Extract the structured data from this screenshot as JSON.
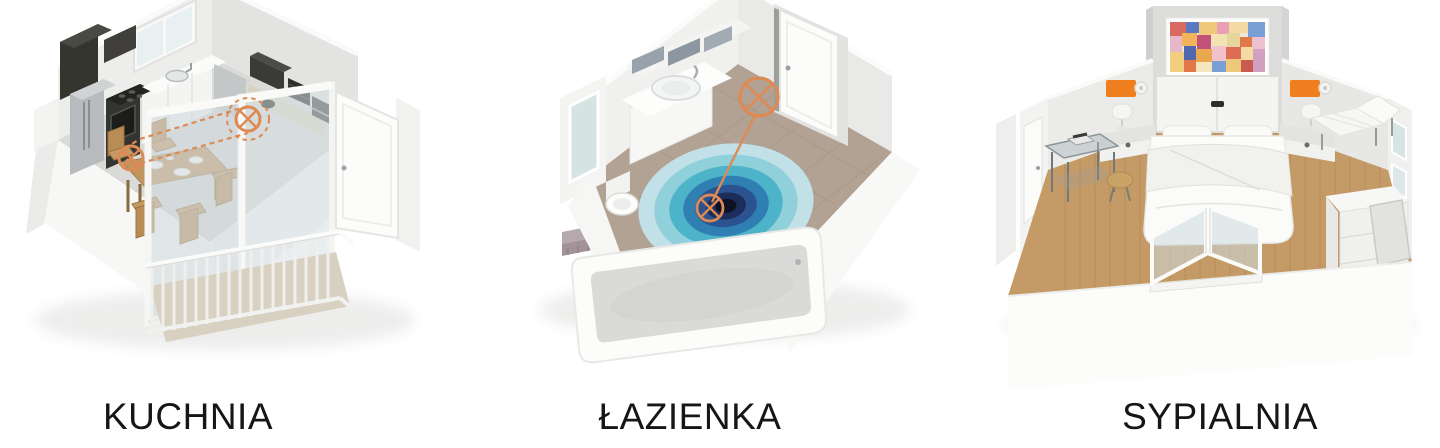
{
  "page": {
    "background": "#ffffff"
  },
  "panels": [
    {
      "id": "kitchen",
      "label": "KUCHNIA",
      "scene": "kitchen-3d-cutaway-render",
      "sensor_count": 2
    },
    {
      "id": "bathroom",
      "label": "ŁAZIENKA",
      "scene": "bathroom-3d-cutaway-render",
      "sensor_count": 2
    },
    {
      "id": "bedroom",
      "label": "SYPIALNIA",
      "scene": "bedroom-3d-cutaway-render",
      "sensor_count": 2
    }
  ],
  "colors": {
    "sensor_orange": "#dd8a55",
    "device_orange": "#ef7f1e",
    "kitchen_floor": "#dadad8",
    "bathroom_floor": "#b2a294",
    "bedroom_floor": "#c49b66",
    "balcony_floor": "#d8d0c0",
    "wood_table": "#c0945e",
    "label_text": "#161616"
  },
  "ripple_colors": [
    "#c2e0e8",
    "#8fd0da",
    "#4db3c8",
    "#2f7fb2",
    "#2a5390",
    "#1c2d5c",
    "#0c1126"
  ],
  "painting_palette": [
    "#d96a62",
    "#5b79c2",
    "#f0c879",
    "#e9a0b4",
    "#f3d9a2",
    "#7a9fd4",
    "#e2784a",
    "#c2527a",
    "#f4e3b2",
    "#d2a0c0"
  ]
}
